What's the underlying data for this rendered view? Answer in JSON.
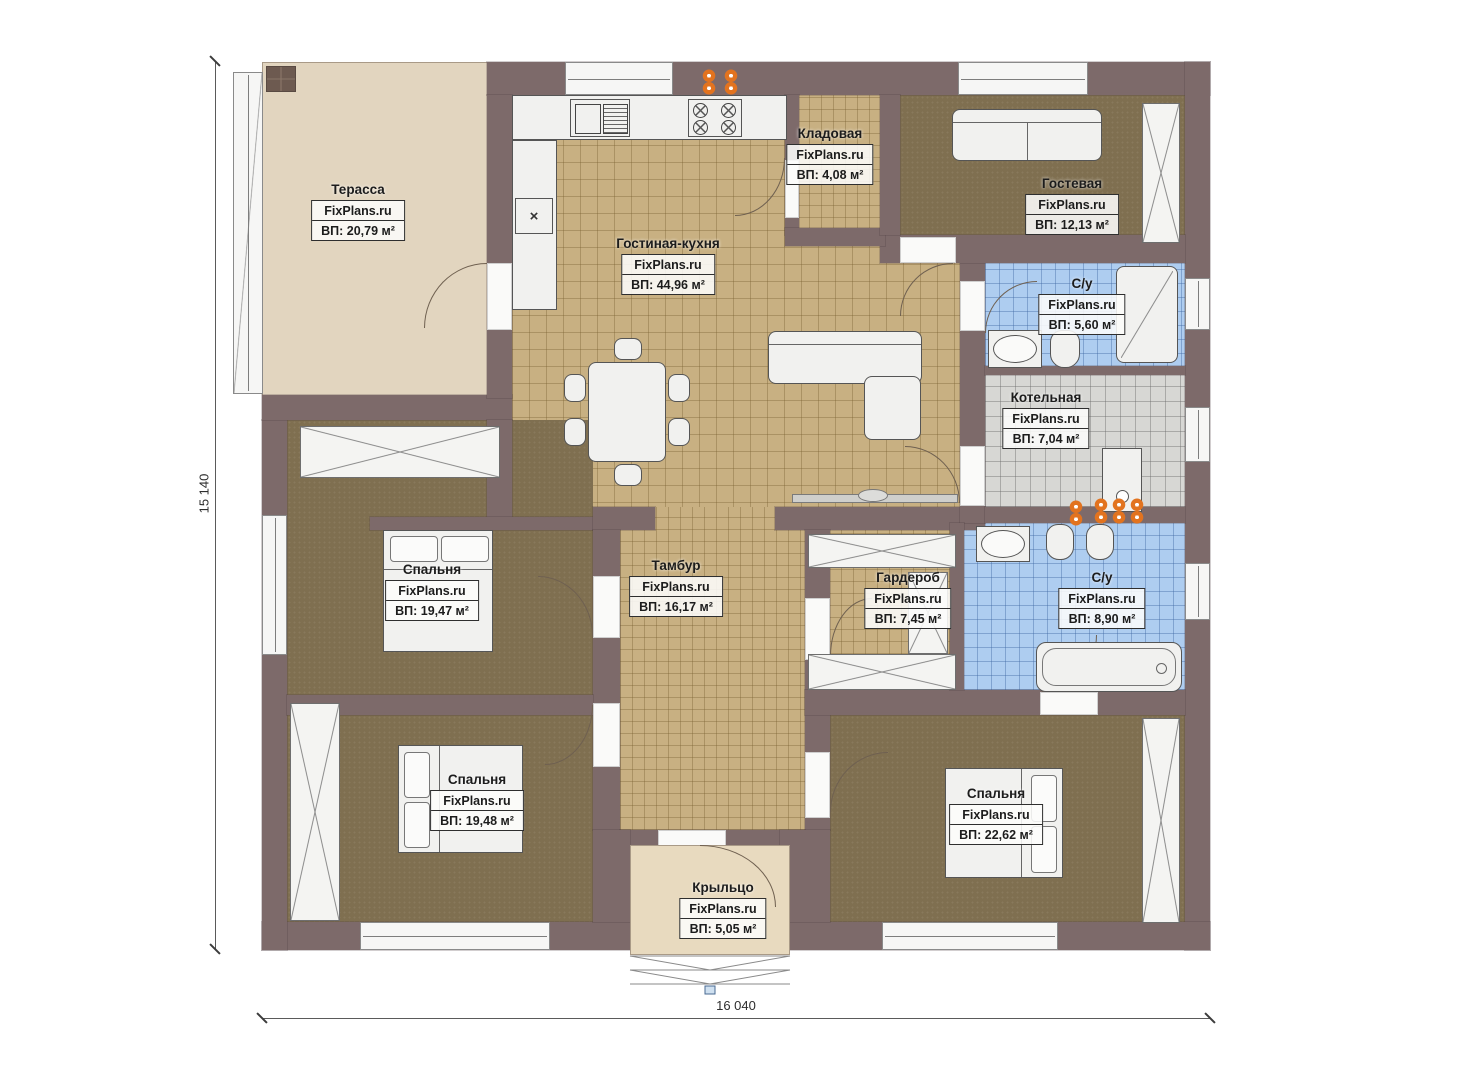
{
  "plan": {
    "brand": "FixPlans.ru",
    "dimensions": {
      "height": "15 140",
      "width": "16 040"
    },
    "icons": {
      "hob": "×"
    },
    "colors": {
      "wall": "#7d6a6a",
      "tile_tan": "#c8b082",
      "carpet": "#7f6f50",
      "tile_blue": "#aecdf0",
      "tile_grey": "#d7d7d4",
      "terrace": "#e2d5bf",
      "accent_orange": "#e2731f"
    },
    "rooms": [
      {
        "id": "terrace",
        "name": "Терасса",
        "area": "ВП: 20,79 м²"
      },
      {
        "id": "living-kitchen",
        "name": "Гостиная-кухня",
        "area": "ВП: 44,96 м²"
      },
      {
        "id": "pantry",
        "name": "Кладовая",
        "area": "ВП: 4,08 м²"
      },
      {
        "id": "guest-room",
        "name": "Гостевая",
        "area": "ВП: 12,13 м²"
      },
      {
        "id": "bathroom-top",
        "name": "С/у",
        "area": "ВП: 5,60 м²"
      },
      {
        "id": "boiler-room",
        "name": "Котельная",
        "area": "ВП: 7,04 м²"
      },
      {
        "id": "bedroom-left",
        "name": "Спальня",
        "area": "ВП: 19,47 м²"
      },
      {
        "id": "vestibule",
        "name": "Тамбур",
        "area": "ВП: 16,17 м²"
      },
      {
        "id": "wardrobe",
        "name": "Гардероб",
        "area": "ВП: 7,45 м²"
      },
      {
        "id": "bathroom-bottom",
        "name": "С/у",
        "area": "ВП: 8,90 м²"
      },
      {
        "id": "bedroom-bottom-left",
        "name": "Спальня",
        "area": "ВП: 19,48 м²"
      },
      {
        "id": "bedroom-bottom-right",
        "name": "Спальня",
        "area": "ВП: 22,62 м²"
      },
      {
        "id": "porch",
        "name": "Крыльцо",
        "area": "ВП: 5,05 м²"
      }
    ]
  }
}
